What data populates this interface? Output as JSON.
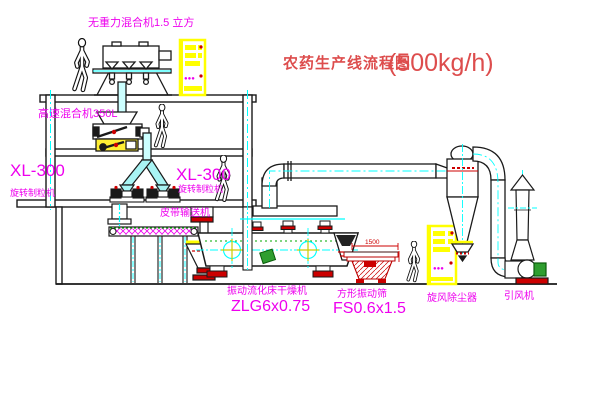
{
  "title": {
    "text": "农药生产线流程图",
    "capacity": "(500kg/h)"
  },
  "equipment": {
    "gravity_mixer_label": "无重力混合机1.5 立方",
    "high_speed_mixer_label": "高速混合机350L",
    "granulator_left": {
      "model": "XL-300",
      "name": "旋转制粒机"
    },
    "granulator_center": {
      "model": "XL-300",
      "name": "旋转制粒机"
    },
    "belt_conveyor_label": "皮带输送机",
    "fluid_bed_dryer": {
      "name": "振动流化床干燥机",
      "model": "ZLG6x0.75"
    },
    "vibrating_screen": {
      "name": "方形振动筛",
      "model": "FS0.6x1.5",
      "dimension": "1500"
    },
    "cyclone_label": "旋风除尘器",
    "fan_label": "引风机"
  },
  "control_cabinets": {
    "indicator_marks": "●●●"
  },
  "colors": {
    "label_magenta": "#ee00ee",
    "title_red": "#dd4d4d",
    "accent_red": "#cc0000",
    "equipment_yellow": "#ffff00",
    "centerline_cyan": "#00ffff",
    "motor_green": "#2f9e2f",
    "line_black": "#1a1a1a"
  }
}
